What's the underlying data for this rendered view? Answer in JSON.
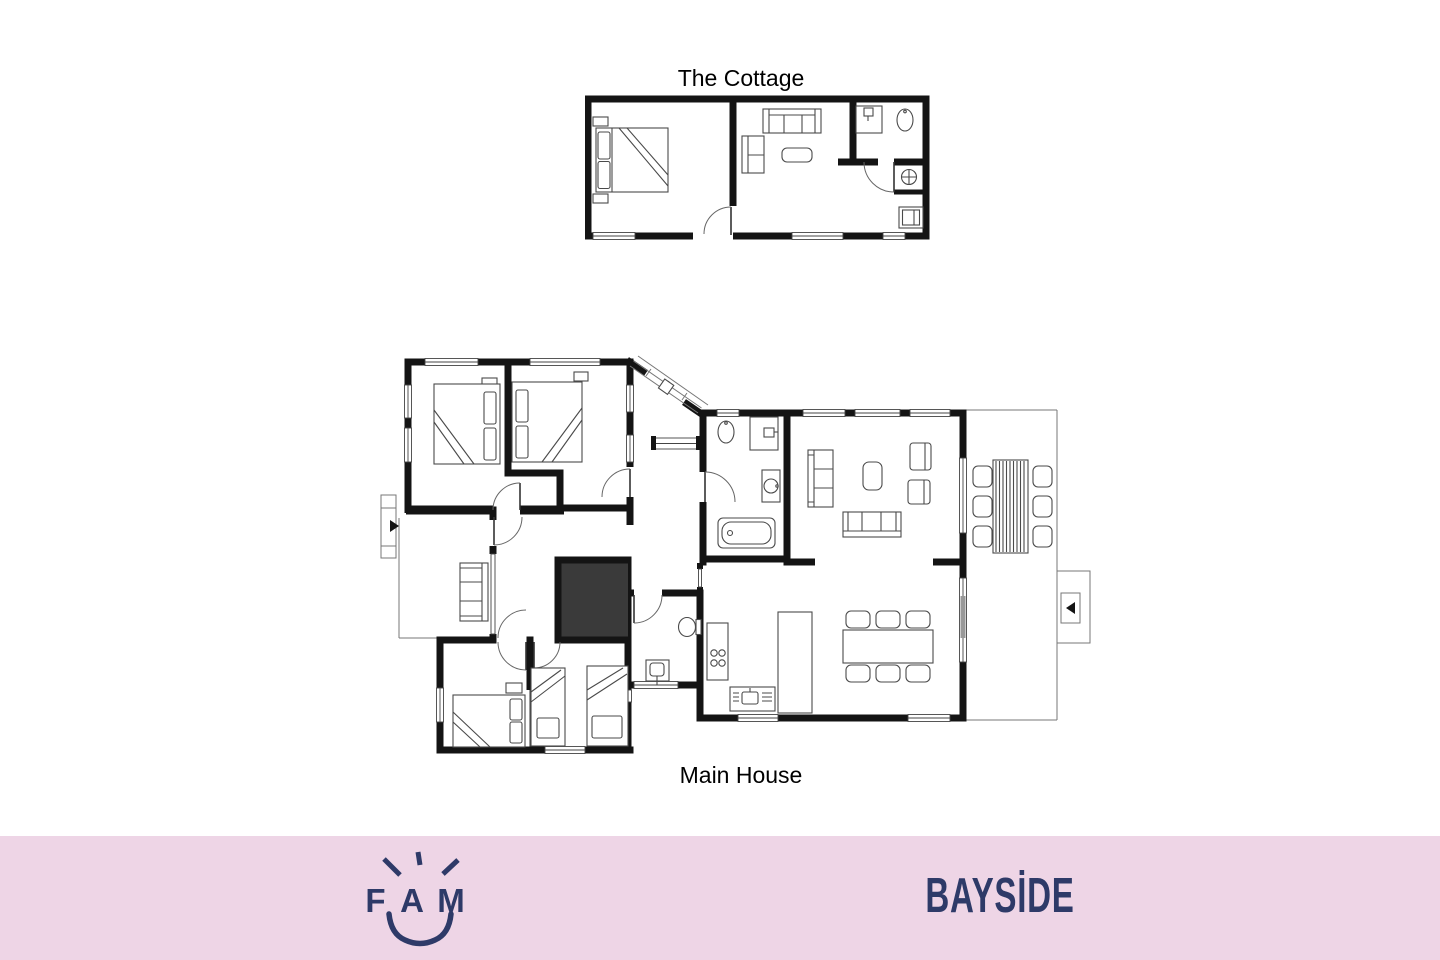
{
  "theme": {
    "wall_color": "#141414",
    "furniture_line_color": "#4a4a4a",
    "dark_room_fill": "#3a3a3a",
    "footer_pink": "#eed5e6",
    "brand_navy": "#2e3a68",
    "label_color": "#000000",
    "window_line": "#444444"
  },
  "floorplans": {
    "cottage": {
      "title": "The Cottage"
    },
    "main_house": {
      "title": "Main House"
    }
  },
  "footer": {
    "fam_letters": [
      "F",
      "A",
      "M"
    ],
    "brand_name": "BAYSİDE"
  }
}
